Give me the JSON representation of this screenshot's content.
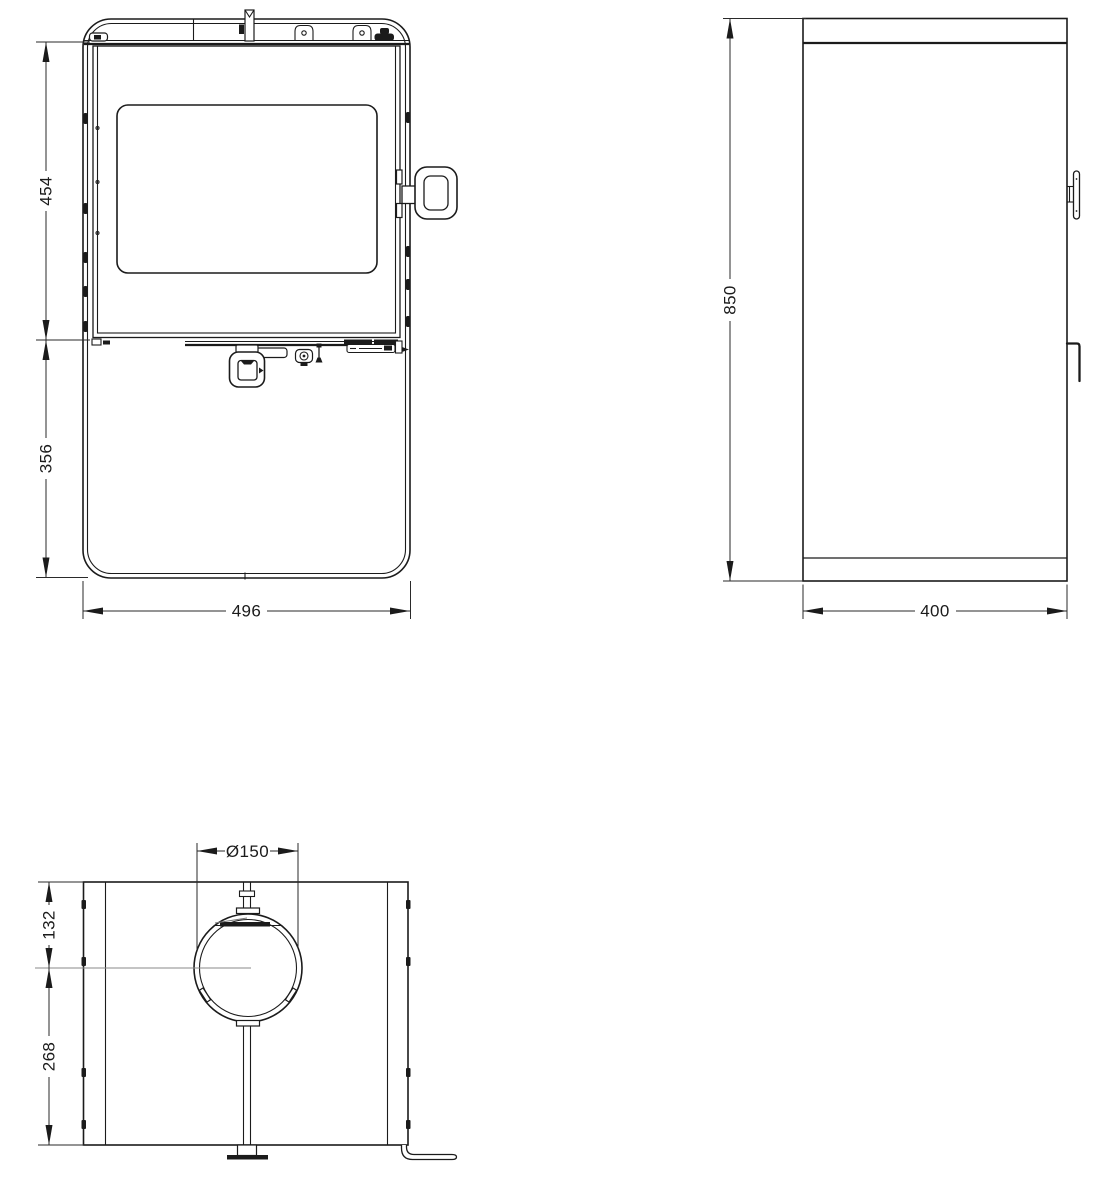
{
  "colors": {
    "line": "#1b1b1b",
    "dimension_line": "#2a2a2a",
    "centerline": "#8a8a8a",
    "background": "#ffffff"
  },
  "views": {
    "front": {
      "dims": {
        "upper_height": "454",
        "lower_height": "356",
        "width": "496"
      }
    },
    "side": {
      "dims": {
        "height": "850",
        "depth": "400"
      }
    },
    "rear": {
      "dims": {
        "flue_diameter": "Ø150",
        "flue_center_from_top": "132",
        "flue_center_to_base": "268"
      }
    }
  }
}
